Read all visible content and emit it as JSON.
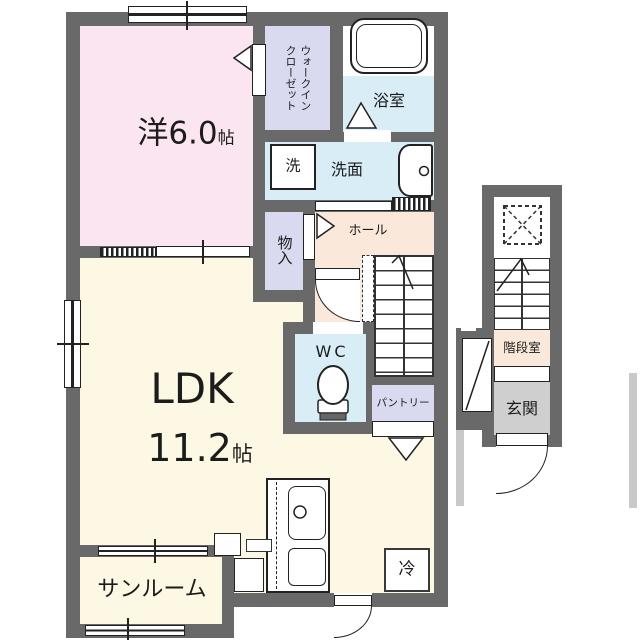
{
  "palette": {
    "wall": "#696969",
    "western_room_fill": "#fbe5f0",
    "closet_fill": "#d9daf0",
    "wet_area_fill": "#d8edf5",
    "ldk_fill": "#fcf8e3",
    "hall_fill": "#fae8da",
    "entrance_fill": "#cfcfcf",
    "line": "#222222"
  },
  "rooms": {
    "western": {
      "label": "洋6.0",
      "unit": "帖"
    },
    "wic": {
      "line1": "ウォークイン",
      "line2": "クローゼット"
    },
    "bathroom": {
      "label": "浴室"
    },
    "washer": {
      "label": "洗"
    },
    "washroom": {
      "label": "洗面"
    },
    "storage": {
      "label": "物入"
    },
    "hall": {
      "label": "ホール"
    },
    "wc": {
      "label": "WC"
    },
    "pantry": {
      "label": "パントリー"
    },
    "ldk": {
      "label": "LDK",
      "size": "11.2",
      "unit": "帖"
    },
    "sunroom": {
      "label": "サンルーム"
    },
    "fridge": {
      "label": "冷"
    },
    "stairwell": {
      "label": "階段室"
    },
    "entrance": {
      "label": "玄関"
    }
  }
}
